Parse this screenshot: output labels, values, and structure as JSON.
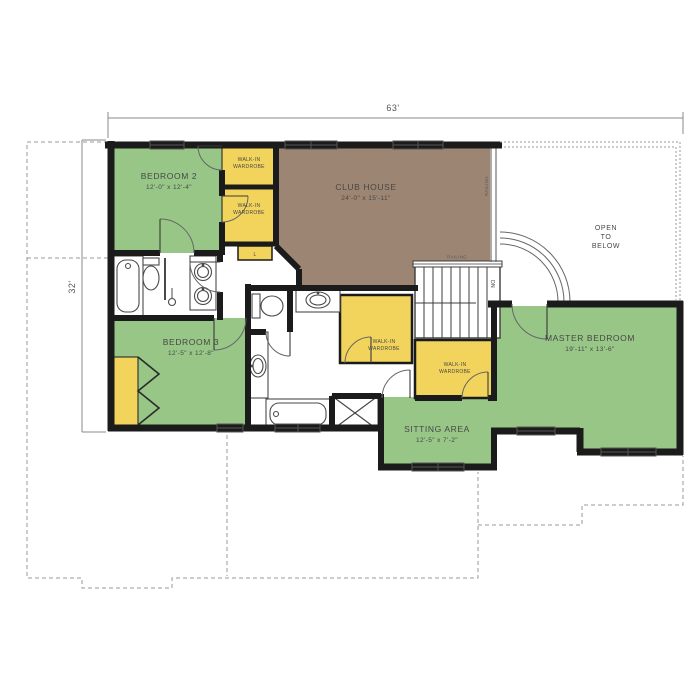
{
  "dimensions": {
    "width_label": "63'",
    "height_label": "32'"
  },
  "rooms": {
    "bedroom2": {
      "name": "BEDROOM 2",
      "size": "12'-0\" x 12'-4\""
    },
    "bedroom3": {
      "name": "BEDROOM 3",
      "size": "12'-5\" x 12'-8\""
    },
    "club_house": {
      "name": "CLUB HOUSE",
      "size": "24'-0\" x 15'-11\""
    },
    "master": {
      "name": "MASTER BEDROOM",
      "size": "19'-11\" x 13'-6\""
    },
    "sitting": {
      "name": "SITTING AREA",
      "size": "12'-5\" x 7'-2\""
    },
    "open_below": {
      "line1": "OPEN",
      "line2": "TO",
      "line3": "BELOW"
    }
  },
  "closets": {
    "walk_in_line1": "WALK-IN",
    "walk_in_line2": "WARDROBE",
    "linen": "L"
  },
  "labels": {
    "railing": "RAILING",
    "down": "DN"
  },
  "colors": {
    "room_green": "#97C687",
    "closet_yellow": "#F2D45C",
    "club_brown": "#9C8573",
    "wall_black": "#1b1b1b"
  }
}
